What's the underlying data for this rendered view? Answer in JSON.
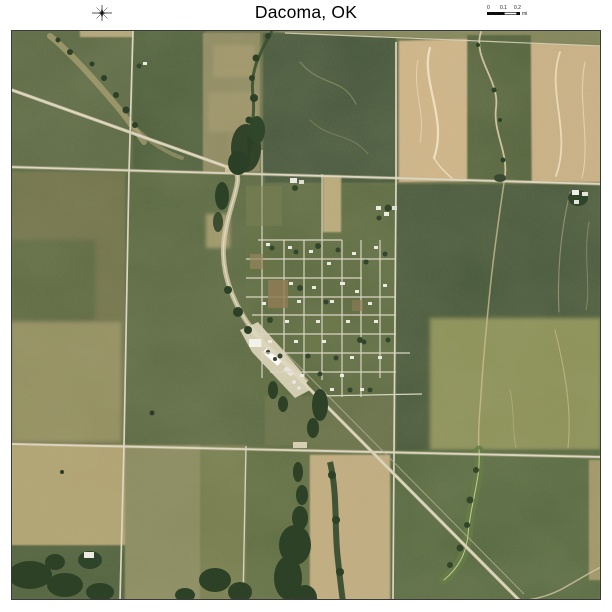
{
  "header": {
    "title": "Dacoma, OK",
    "scale_bar": {
      "tick_labels": [
        "0",
        "0.1",
        "0.2"
      ],
      "unit_label": "mi"
    }
  },
  "map": {
    "colors": {
      "field_green_dark": "#44563A",
      "field_green": "#5C6A44",
      "field_olive_mottled": "#8F8A62",
      "field_tan": "#D2B68A",
      "road_light": "#DCD6C2",
      "creek_trees": "#2C4126",
      "rail_corridor": "#D5CAA9",
      "background": "#FFFFFF"
    }
  }
}
